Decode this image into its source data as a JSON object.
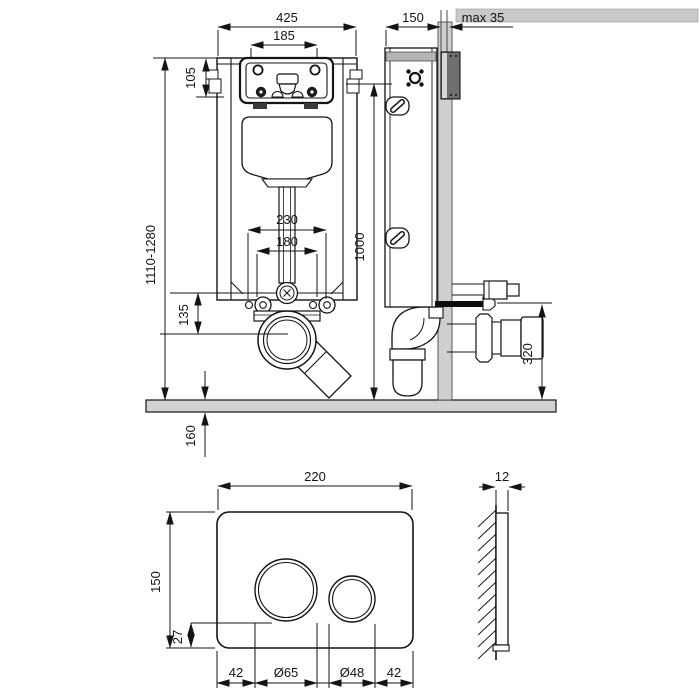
{
  "drawing": {
    "front_view": {
      "frame_width": "425",
      "access_opening_width": "185",
      "access_box_offset": "105",
      "install_height_range": "1110-1280",
      "bolt_spacing_outer": "230",
      "bolt_spacing_inner": "180",
      "outlet_drop": "135",
      "outlet_floor_offset": "160"
    },
    "side_view": {
      "frame_depth": "150",
      "wall_finish_max": "max 35",
      "panel_height": "1000",
      "outlet_height": "320"
    },
    "flush_plate_front": {
      "plate_width": "220",
      "plate_height": "150",
      "button_bottom_offset": "27",
      "left_margin": "42",
      "large_button_diameter": "Ø65",
      "small_button_diameter": "Ø48",
      "right_margin": "42"
    },
    "flush_plate_side": {
      "plate_thickness": "12"
    },
    "colors": {
      "line": "#141414",
      "floor_wall_gray": "#d2d2d2",
      "dark_block_gray": "#6f6f6f",
      "background": "#ffffff"
    }
  }
}
